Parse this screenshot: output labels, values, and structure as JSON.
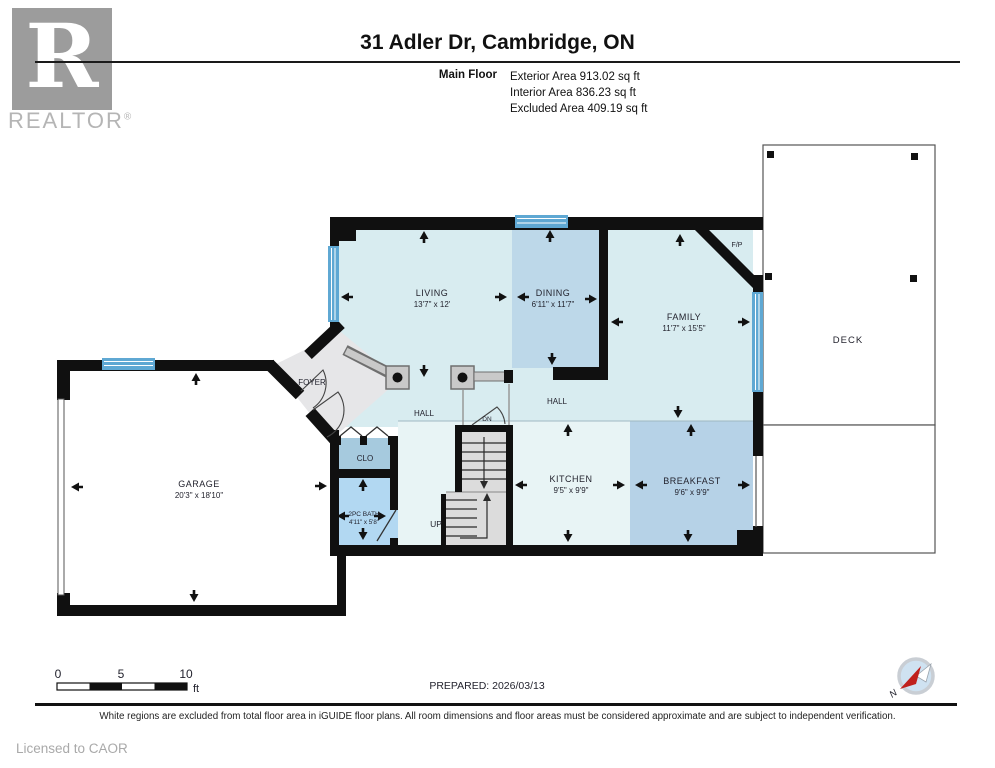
{
  "header": {
    "logo_r": "R",
    "logo_text": "REALTOR",
    "logo_reg": "®",
    "title": "31 Adler Dr, Cambridge, ON",
    "floor_label": "Main Floor",
    "areas": {
      "exterior": "Exterior Area 913.02 sq ft",
      "interior": "Interior Area 836.23 sq ft",
      "excluded": "Excluded Area 409.19 sq ft"
    }
  },
  "rooms": {
    "living": {
      "name": "LIVING",
      "dims": "13'7\" x 12'"
    },
    "dining": {
      "name": "DINING",
      "dims": "6'11\" x 11'7\""
    },
    "family": {
      "name": "FAMILY",
      "dims": "11'7\" x 15'5\""
    },
    "kitchen": {
      "name": "KITCHEN",
      "dims": "9'5\" x 9'9\""
    },
    "breakfast": {
      "name": "BREAKFAST",
      "dims": "9'6\" x 9'9\""
    },
    "garage": {
      "name": "GARAGE",
      "dims": "20'3\" x 18'10\""
    },
    "bath": {
      "name": "2PC BATH",
      "dims": "4'11\" x 5'8\""
    },
    "foyer": {
      "name": "FOYER"
    },
    "closet": {
      "name": "CLO"
    },
    "hall_upper": {
      "name": "HALL"
    },
    "hall_lower": {
      "name": "HALL"
    },
    "deck": {
      "name": "DECK"
    },
    "fireplace": {
      "name": "F/P"
    },
    "stairs_up": {
      "name": "UP"
    },
    "stairs_dn": {
      "name": "DN"
    }
  },
  "scale_bar": {
    "t0": "0",
    "t5": "5",
    "t10": "10",
    "unit": "ft"
  },
  "footer": {
    "prepared": "PREPARED: 2026/03/13",
    "compass_n": "N",
    "disclaimer": "White regions are excluded from total floor area in iGUIDE floor plans. All room dimensions and floor areas must be considered approximate and are subject to independent verification.",
    "license": "Licensed to CAOR"
  },
  "colors": {
    "wall": "#101010",
    "room_light": "#d8ecf0",
    "room_medium_blue": "#bdd8e9",
    "breakfast_blue": "#b6d2e7",
    "bath_blue": "#b2d8f2",
    "closet_blue": "#a6cade",
    "kitchen_light": "#e8f4f5",
    "foyer_gray": "#e6e6e8",
    "window_blue": "#5fa8d3",
    "stair_gray": "#dcdcdc",
    "compass_red": "#c0201c"
  }
}
